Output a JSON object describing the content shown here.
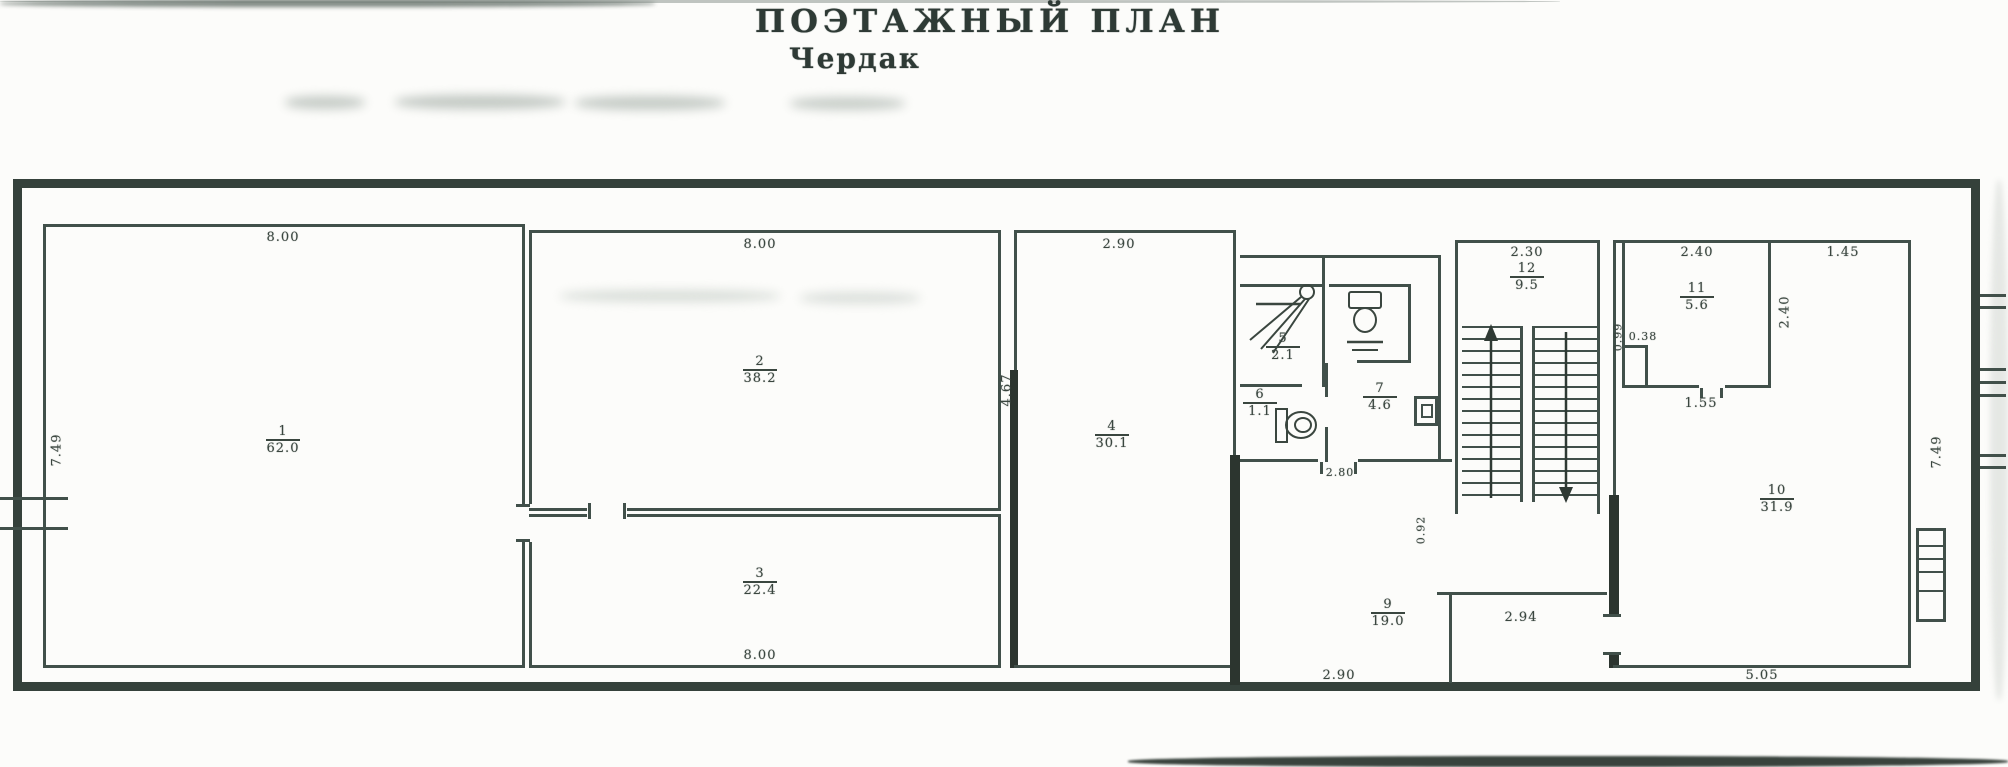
{
  "title": {
    "line1": "ПОЭТАЖНЫЙ ПЛАН",
    "line2": "Чердак"
  },
  "plan": {
    "colors": {
      "wall": "#41504a",
      "outer_wall": "#35413b",
      "text": "#3a463f"
    },
    "rooms": [
      {
        "id": "room-1",
        "number": "1",
        "area": "62.0",
        "x": 283,
        "y": 425
      },
      {
        "id": "room-2",
        "number": "2",
        "area": "38.2",
        "x": 760,
        "y": 355
      },
      {
        "id": "room-3",
        "number": "3",
        "area": "22.4",
        "x": 760,
        "y": 567
      },
      {
        "id": "room-4",
        "number": "4",
        "area": "30.1",
        "x": 1112,
        "y": 420
      },
      {
        "id": "room-5-shower",
        "number": "5",
        "area": "2.1",
        "x": 1283,
        "y": 332
      },
      {
        "id": "room-6-wc",
        "number": "6",
        "area": "1.1",
        "x": 1260,
        "y": 388
      },
      {
        "id": "room-7",
        "number": "7",
        "area": "4.6",
        "x": 1380,
        "y": 382
      },
      {
        "id": "room-9",
        "number": "9",
        "area": "19.0",
        "x": 1388,
        "y": 598
      },
      {
        "id": "room-10",
        "number": "10",
        "area": "31.9",
        "x": 1777,
        "y": 484
      },
      {
        "id": "room-11",
        "number": "11",
        "area": "5.6",
        "x": 1697,
        "y": 282
      },
      {
        "id": "room-12-stairs",
        "number": "12",
        "area": "9.5",
        "x": 1527,
        "y": 262
      }
    ],
    "dimensions": [
      {
        "id": "dim-top-room1",
        "text": "8.00",
        "x": 283,
        "y": 230
      },
      {
        "id": "dim-top-room2",
        "text": "8.00",
        "x": 760,
        "y": 237
      },
      {
        "id": "dim-top-room4",
        "text": "2.90",
        "x": 1119,
        "y": 237
      },
      {
        "id": "dim-top-stairs",
        "text": "2.30",
        "x": 1527,
        "y": 245
      },
      {
        "id": "dim-top-room11",
        "text": "2.40",
        "x": 1697,
        "y": 245
      },
      {
        "id": "dim-top-bay",
        "text": "1.45",
        "x": 1843,
        "y": 245
      },
      {
        "id": "dim-bottom-room3",
        "text": "8.00",
        "x": 760,
        "y": 648
      },
      {
        "id": "dim-bottom-room9",
        "text": "2.90",
        "x": 1339,
        "y": 668
      },
      {
        "id": "dim-under-stairs",
        "text": "2.94",
        "x": 1521,
        "y": 610
      },
      {
        "id": "dim-bottom-room10",
        "text": "5.05",
        "x": 1762,
        "y": 668
      },
      {
        "id": "dim-left-height",
        "text": "7.49",
        "x": 57,
        "y": 450,
        "rot": true
      },
      {
        "id": "dim-right-height",
        "text": "7.49",
        "x": 1937,
        "y": 452,
        "rot": true
      },
      {
        "id": "dim-room2-height",
        "text": "4.67",
        "x": 1007,
        "y": 390,
        "rot": true
      },
      {
        "id": "dim-room11-bottom",
        "text": "1.55",
        "x": 1701,
        "y": 396
      },
      {
        "id": "dim-room11-right",
        "text": "2.40",
        "x": 1785,
        "y": 312,
        "rot": true
      },
      {
        "id": "dim-room11-notch-a",
        "text": "0.99",
        "x": 1618,
        "y": 337,
        "rot": true,
        "small": true
      },
      {
        "id": "dim-room11-notch-b",
        "text": "0.38",
        "x": 1643,
        "y": 330,
        "small": true
      },
      {
        "id": "dim-stair-passage",
        "text": "0.92",
        "x": 1421,
        "y": 530,
        "rot": true,
        "small": true
      },
      {
        "id": "dim-bath-door",
        "text": "2.80",
        "x": 1340,
        "y": 466,
        "small": true
      }
    ],
    "symbols": {
      "shower": "shower-spray",
      "toilet_top": "toilet",
      "toilet_wc": "toilet",
      "stairs_up": "arrow-up",
      "stairs_down": "arrow-down",
      "roof_window": "window-rungs"
    }
  }
}
